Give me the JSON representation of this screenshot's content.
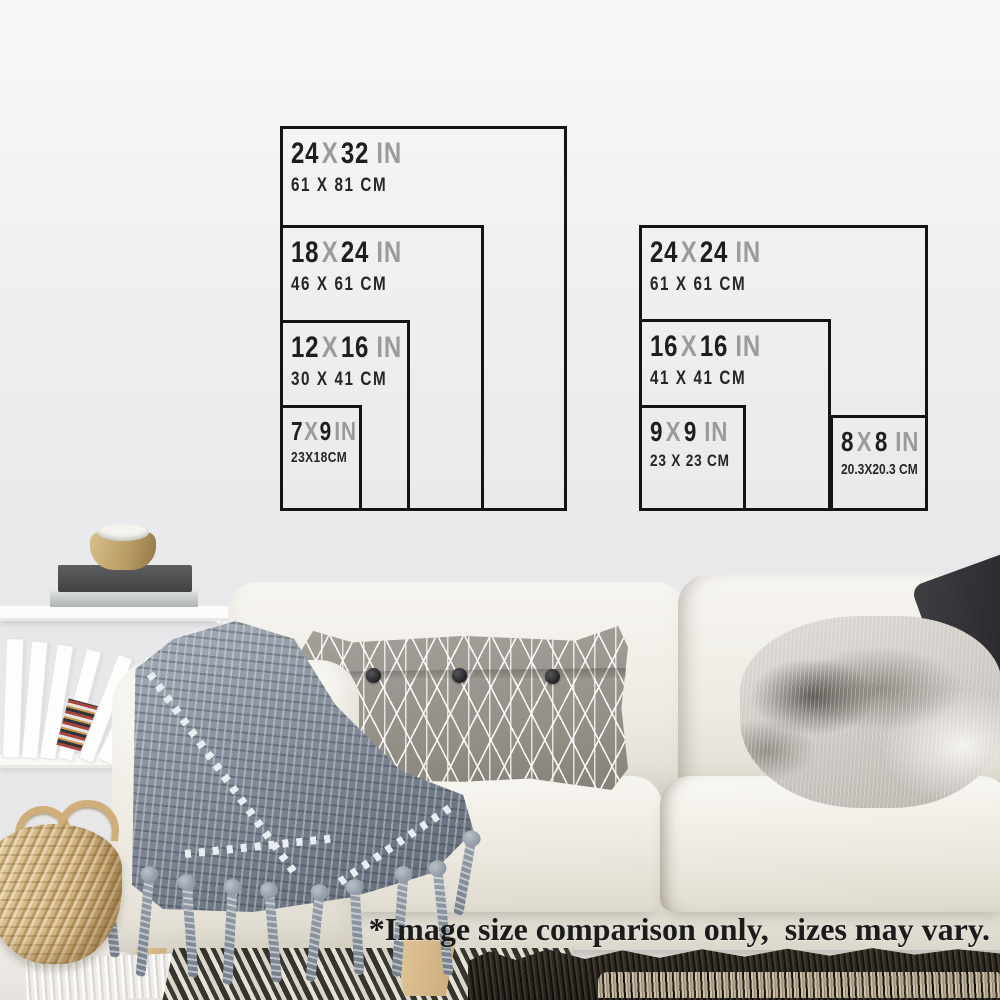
{
  "colors": {
    "diagram_line": "#141414",
    "size_number": "#1e1e1e",
    "size_muted": "#9b9b9b",
    "cm_text": "#262626",
    "disclaimer_text": "#1b1b1b",
    "wall": "#ebebed"
  },
  "portrait_diagram": {
    "sizes": [
      {
        "inches_w": "24",
        "x": "X",
        "inches_h": "32",
        "unit": "IN",
        "cm": "61 X 81 CM"
      },
      {
        "inches_w": "18",
        "x": "X",
        "inches_h": "24",
        "unit": "IN",
        "cm": "46 X 61 CM"
      },
      {
        "inches_w": "12",
        "x": "X",
        "inches_h": "16",
        "unit": "IN",
        "cm": "30 X 41 CM"
      },
      {
        "inches_w": "7",
        "x": "X",
        "inches_h": "9",
        "unit": "IN",
        "cm": "23X18CM"
      }
    ]
  },
  "square_diagram": {
    "sizes": [
      {
        "inches_w": "24",
        "x": "X",
        "inches_h": "24",
        "unit": "IN",
        "cm": "61 X 61 CM"
      },
      {
        "inches_w": "16",
        "x": "X",
        "inches_h": "16",
        "unit": "IN",
        "cm": "41 X 41 CM"
      },
      {
        "inches_w": "9",
        "x": "X",
        "inches_h": "9",
        "unit": "IN",
        "cm": "23 X 23 CM"
      },
      {
        "inches_w": "8",
        "x": "X",
        "inches_h": "8",
        "unit": "IN",
        "cm": "20.3X20.3 CM"
      }
    ]
  },
  "disclaimer": {
    "text": "*Image size comparison only,  sizes may vary."
  }
}
